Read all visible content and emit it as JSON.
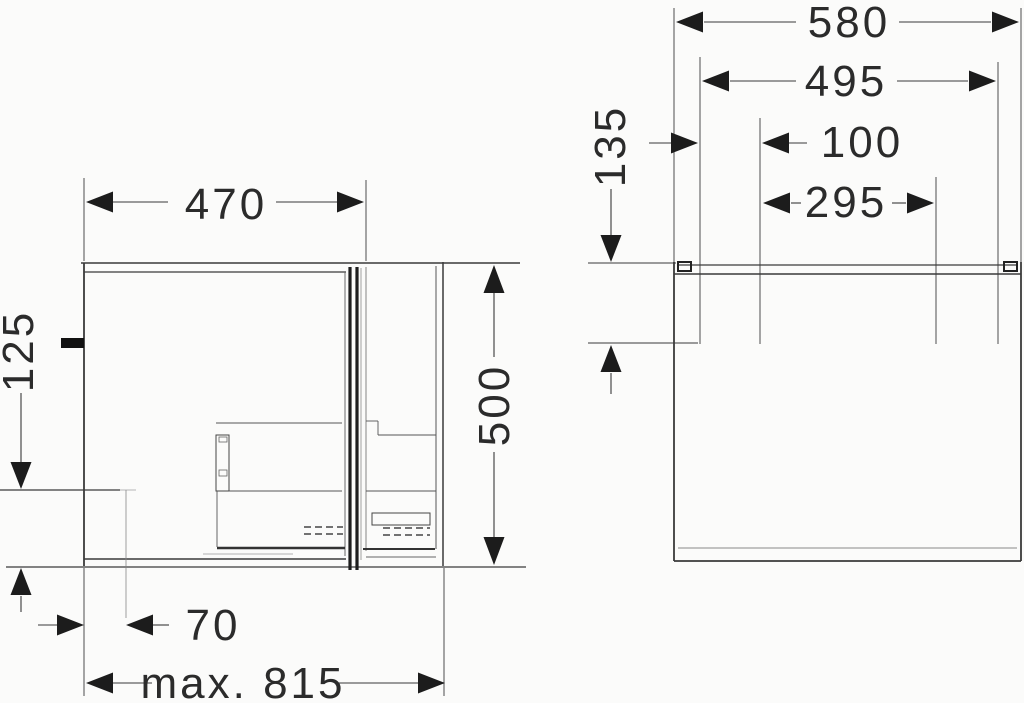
{
  "drawing": {
    "title": "vanity-unit-dimension-drawing",
    "background": "#fbfbfa",
    "line_color": "#3a3a3a",
    "arrow_color": "#1c1c1c",
    "side_view": {
      "depth": "470",
      "height": "500",
      "bottom_offset": "125",
      "rail_offset": "70",
      "max_extension": "max. 815"
    },
    "front_view": {
      "width": "580",
      "inner_width": "495",
      "hole_offset": "100",
      "hole_spacing": "295",
      "top_offset": "135"
    }
  }
}
